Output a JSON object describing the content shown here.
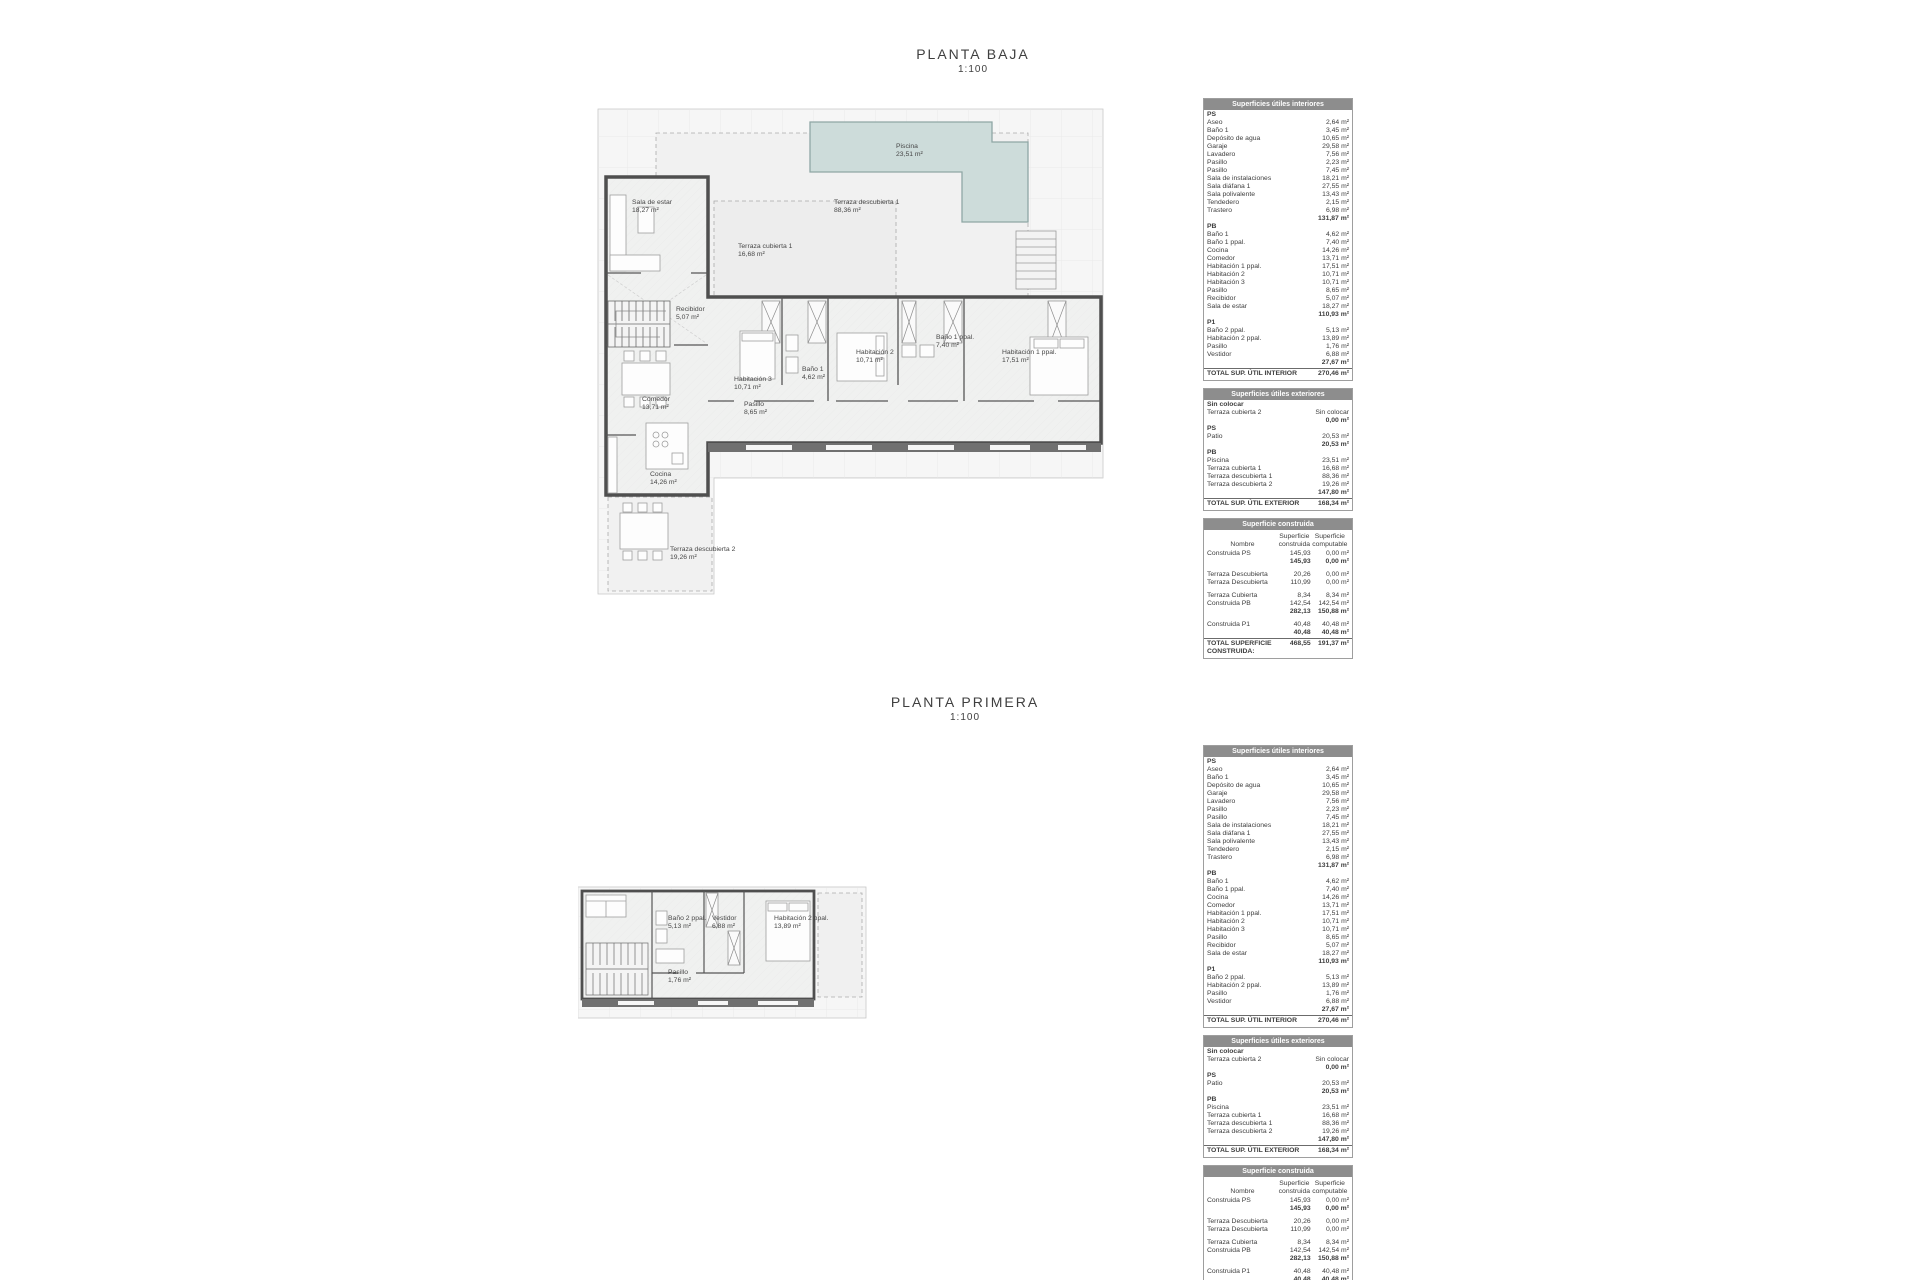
{
  "sheets": [
    {
      "title": "PLANTA BAJA",
      "scale": "1:100"
    },
    {
      "title": "PLANTA PRIMERA",
      "scale": "1:100"
    }
  ],
  "colors": {
    "table_header_bg": "#8d8d8d",
    "table_header_text": "#ffffff",
    "pool_fill": "#cddcda",
    "pool_border": "#8fa7a5",
    "wall": "#4f4f4f",
    "text": "#3d3d3d"
  },
  "plans": {
    "planta_baja": {
      "rooms": [
        {
          "label": "Piscina",
          "area": "23,51 m²",
          "x": 300,
          "y": 38
        },
        {
          "label": "Terraza descubierta 1",
          "area": "88,36 m²",
          "x": 238,
          "y": 94
        },
        {
          "label": "Sala de estar",
          "area": "18,27 m²",
          "x": 36,
          "y": 94
        },
        {
          "label": "Terraza cubierta 1",
          "area": "16,68 m²",
          "x": 142,
          "y": 138
        },
        {
          "label": "Recibidor",
          "area": "5,07 m²",
          "x": 80,
          "y": 201
        },
        {
          "label": "Comedor",
          "area": "13,71 m²",
          "x": 46,
          "y": 291
        },
        {
          "label": "Cocina",
          "area": "14,26 m²",
          "x": 54,
          "y": 366
        },
        {
          "label": "Terraza descubierta 2",
          "area": "19,26 m²",
          "x": 74,
          "y": 441
        },
        {
          "label": "Habitación 3",
          "area": "10,71 m²",
          "x": 138,
          "y": 271
        },
        {
          "label": "Baño 1",
          "area": "4,62 m²",
          "x": 206,
          "y": 261
        },
        {
          "label": "Habitación 2",
          "area": "10,71 m²",
          "x": 260,
          "y": 244
        },
        {
          "label": "Baño 1 ppal.",
          "area": "7,40 m²",
          "x": 340,
          "y": 229
        },
        {
          "label": "Habitación 1 ppal.",
          "area": "17,51 m²",
          "x": 406,
          "y": 244
        },
        {
          "label": "Pasillo",
          "area": "8,65 m²",
          "x": 148,
          "y": 296
        }
      ]
    },
    "planta_primera": {
      "rooms": [
        {
          "label": "Baño 2 ppal.",
          "area": "5,13 m²",
          "x": 90,
          "y": 30
        },
        {
          "label": "Vestidor",
          "area": "6,88 m²",
          "x": 134,
          "y": 30
        },
        {
          "label": "Habitación 2 ppal.",
          "area": "13,89 m²",
          "x": 196,
          "y": 30
        },
        {
          "label": "Pasillo",
          "area": "1,76 m²",
          "x": 90,
          "y": 84
        }
      ]
    }
  },
  "tables": {
    "interiores": {
      "title": "Superficies útiles interiores",
      "sections": [
        {
          "header": "PS",
          "rows": [
            [
              "Aseo",
              "2,64 m²"
            ],
            [
              "Baño 1",
              "3,45 m²"
            ],
            [
              "Depósito de agua",
              "10,65 m²"
            ],
            [
              "Garaje",
              "29,58 m²"
            ],
            [
              "Lavadero",
              "7,56 m²"
            ],
            [
              "Pasillo",
              "2,23 m²"
            ],
            [
              "Pasillo",
              "7,45 m²"
            ],
            [
              "Sala de instalaciones",
              "18,21 m²"
            ],
            [
              "Sala diáfana 1",
              "27,55 m²"
            ],
            [
              "Sala polivalente",
              "13,43 m²"
            ],
            [
              "Tendedero",
              "2,15 m²"
            ],
            [
              "Trastero",
              "6,98 m²"
            ]
          ],
          "subtotal": "131,87 m²"
        },
        {
          "header": "PB",
          "rows": [
            [
              "Baño 1",
              "4,62 m²"
            ],
            [
              "Baño 1 ppal.",
              "7,40 m²"
            ],
            [
              "Cocina",
              "14,26 m²"
            ],
            [
              "Comedor",
              "13,71 m²"
            ],
            [
              "Habitación 1 ppal.",
              "17,51 m²"
            ],
            [
              "Habitación 2",
              "10,71 m²"
            ],
            [
              "Habitación 3",
              "10,71 m²"
            ],
            [
              "Pasillo",
              "8,65 m²"
            ],
            [
              "Recibidor",
              "5,07 m²"
            ],
            [
              "Sala de estar",
              "18,27 m²"
            ]
          ],
          "subtotal": "110,93 m²"
        },
        {
          "header": "P1",
          "rows": [
            [
              "Baño 2 ppal.",
              "5,13 m²"
            ],
            [
              "Habitación 2 ppal.",
              "13,89 m²"
            ],
            [
              "Pasillo",
              "1,76 m²"
            ],
            [
              "Vestidor",
              "6,88 m²"
            ]
          ],
          "subtotal": "27,67 m²"
        }
      ],
      "total_label": "TOTAL SUP.  ÚTIL INTERIOR",
      "total_value": "270,46 m²"
    },
    "exteriores": {
      "title": "Superficies útiles exteriores",
      "sections": [
        {
          "header": "Sin colocar",
          "rows": [
            [
              "Terraza cubierta 2",
              "Sin colocar"
            ]
          ],
          "subtotal": "0,00 m²"
        },
        {
          "header": "PS",
          "rows": [
            [
              "Patio",
              "20,53 m²"
            ]
          ],
          "subtotal": "20,53 m²"
        },
        {
          "header": "PB",
          "rows": [
            [
              "Piscina",
              "23,51 m²"
            ],
            [
              "Terraza cubierta 1",
              "16,68 m²"
            ],
            [
              "Terraza descubierta 1",
              "88,36 m²"
            ],
            [
              "Terraza descubierta 2",
              "19,26 m²"
            ]
          ],
          "subtotal": "147,80 m²"
        }
      ],
      "total_label": "TOTAL SUP.  ÚTIL EXTERIOR",
      "total_value": "168,34 m²"
    },
    "construida": {
      "title": "Superficie construida",
      "col_headers": [
        "Nombre",
        "Superficie\nconstruida",
        "Superficie\ncomputable"
      ],
      "groups": [
        {
          "rows": [
            [
              "Construida PS",
              "145,93",
              "0,00 m²"
            ]
          ],
          "subtotal": [
            "145,93",
            "0,00 m²"
          ]
        },
        {
          "rows": [
            [
              "Terraza Descubierta",
              "20,26",
              "0,00 m²"
            ],
            [
              "Terraza Descubierta",
              "110,99",
              "0,00 m²"
            ]
          ],
          "subtotal": null
        },
        {
          "rows": [
            [
              "Terraza Cubierta",
              "8,34",
              "8,34 m²"
            ],
            [
              "Construida PB",
              "142,54",
              "142,54 m²"
            ]
          ],
          "subtotal": [
            "282,13",
            "150,88 m²"
          ]
        },
        {
          "rows": [
            [
              "Construida P1",
              "40,48",
              "40,48 m²"
            ]
          ],
          "subtotal": [
            "40,48",
            "40,48 m²"
          ]
        }
      ],
      "total_label": "TOTAL SUPERFICIE CONSTRUIDA:",
      "total_value": [
        "468,55",
        "191,37 m²"
      ]
    }
  }
}
